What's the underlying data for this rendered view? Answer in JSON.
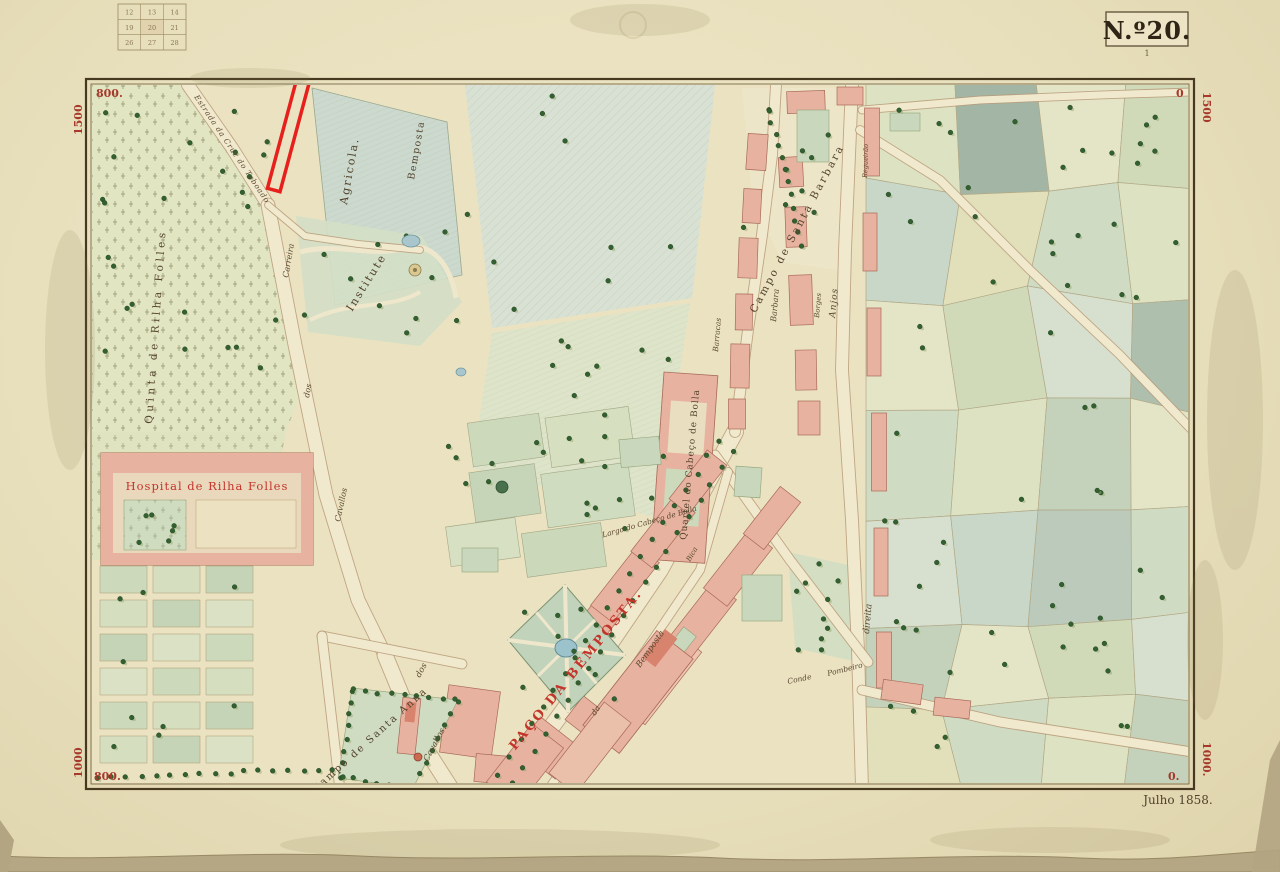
{
  "sheet": {
    "number": "N.º20.",
    "number_note": "1",
    "date": "Julho 1858.",
    "index_grid": {
      "rows": [
        [
          "12",
          "13",
          "14"
        ],
        [
          "19",
          "20",
          "21"
        ],
        [
          "26",
          "27",
          "28"
        ]
      ]
    },
    "coords": {
      "tl_h": "800.",
      "tl_v": "1500",
      "tr_h": "0",
      "tr_v": "1500",
      "bl_h": "800.",
      "bl_v": "1000",
      "br_h": "0.",
      "br_v": "1000."
    }
  },
  "map": {
    "highlight_color": "#e8201d",
    "labels": {
      "quinta_rilha": "Quinta de Rilha Folles",
      "hospital": "Hospital de Rilha Folles",
      "estrada_taboado": "Estrada da Cruz do Taboado",
      "agricola": "Agricola.",
      "bemposta_field": "Bemposta",
      "institute": "Institute",
      "carreira_1a": "Carreira",
      "carreira_1b": "dos",
      "carreira_1c": "Cavallos",
      "carreira_2a": "dos",
      "carreira_2b": "Cavallos.",
      "campo_anna": "Campo de Santa Anna",
      "paco_bemposta": "PAÇO DA BEMPOSTA.",
      "rua_bemposta_a": "da",
      "rua_bemposta_b": "Bemposta",
      "largo_cabeco": "Largo do Cabeço de Bolla",
      "quartel": "Quartel do Cabeço de Bolla",
      "campo_barbara": "Campo de Santa Barbara",
      "barbara_st": "Barbara",
      "barracas": "Barracas",
      "borges": "Borges",
      "regueirao": "Regueirão",
      "anjos": "Anjos",
      "direita": "direita",
      "bica": "Bica",
      "conde": "Conde",
      "pombeiro": "Pombeiro"
    }
  }
}
